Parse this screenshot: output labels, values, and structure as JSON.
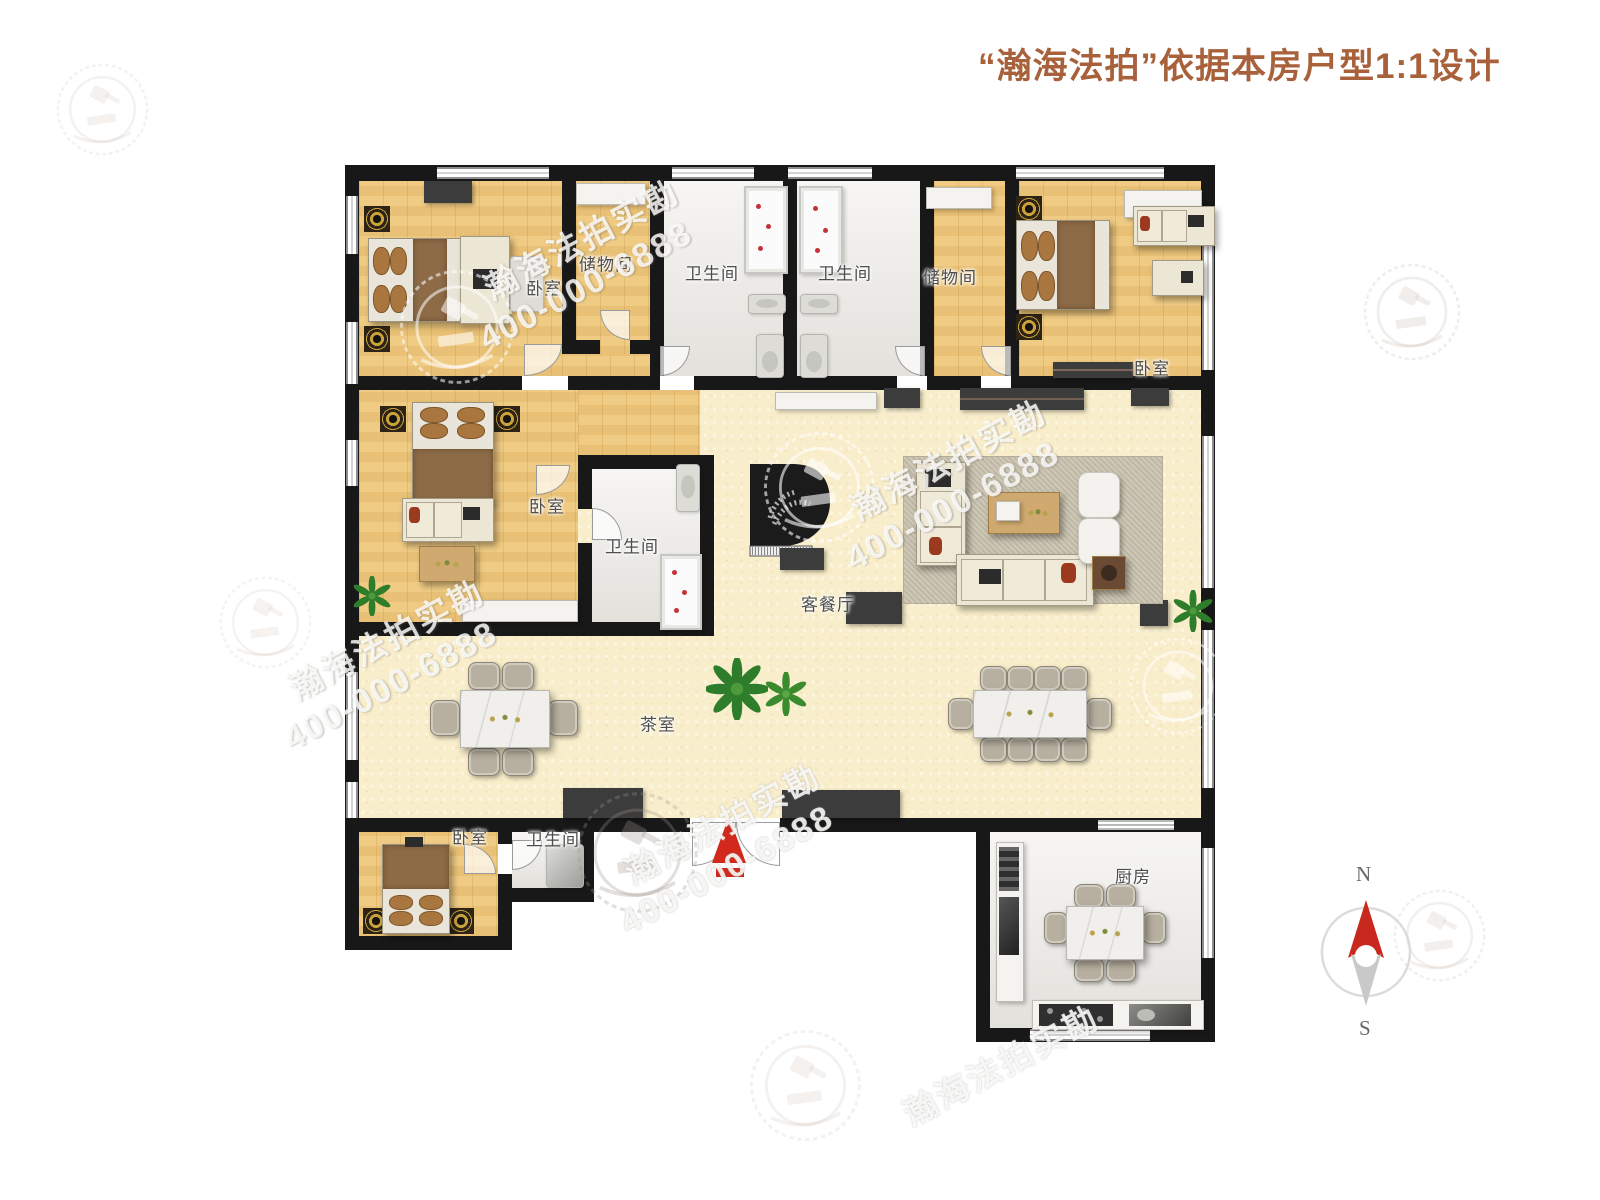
{
  "title": {
    "text": "“瀚海法拍”依据本房户型1:1设计"
  },
  "watermark": {
    "brand": "瀚海法拍实勘",
    "phone": "400-000-6888"
  },
  "compass": {
    "north": "N",
    "south": "S"
  },
  "rooms": {
    "bedroom_tl": "卧室",
    "storage_1": "储物间",
    "bath_1": "卫生间",
    "bath_2": "卫生间",
    "storage_2": "储物间",
    "bedroom_tr": "卧室",
    "bedroom_ml": "卧室",
    "bath_3": "卫生间",
    "living": "客餐厅",
    "tea": "茶室",
    "bedroom_bl": "卧室",
    "bath_4": "卫生间",
    "kitchen": "厨房"
  },
  "colors": {
    "title_accent": "#a8613b",
    "wall": "#181818",
    "wood_floor": "#edc67c",
    "living_floor": "#f9eecb",
    "tile_floor": "#eceae5",
    "entrance_arrow_red": "#d2291c",
    "compass_north_red": "#c8281d"
  }
}
